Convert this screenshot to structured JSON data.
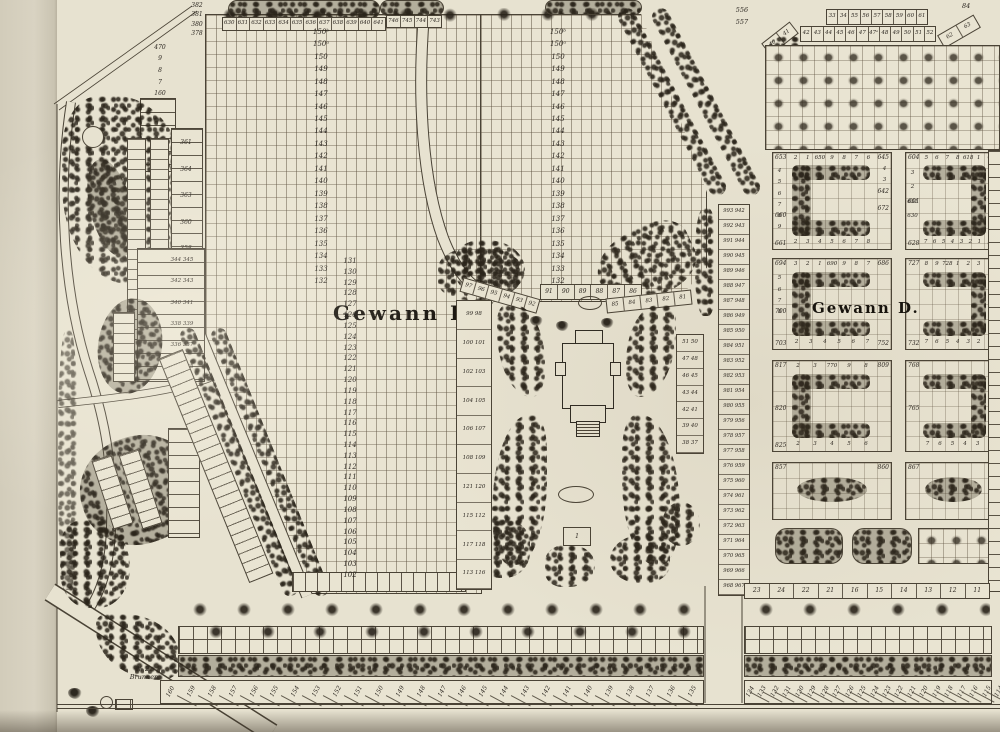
{
  "labels": {
    "gewann_west": "Gewann F.",
    "gewann_east": "Gewann D.",
    "well_no": "№ 2.",
    "well_name": "Brunnen",
    "chapel_plot": "1",
    "corner_right_top": "84"
  },
  "field_columns": {
    "west_upper": [
      "150ᵇ",
      "150ᵃ",
      "150",
      "149",
      "148",
      "147",
      "146",
      "145",
      "144",
      "143",
      "142",
      "141",
      "140",
      "139",
      "138",
      "137",
      "136",
      "135",
      "134",
      "133",
      "132"
    ],
    "west_lower": [
      "131",
      "130",
      "129",
      "128",
      "127",
      "126",
      "125",
      "124",
      "123",
      "122",
      "121",
      "120",
      "119",
      "118",
      "117",
      "116",
      "115",
      "114",
      "113",
      "112",
      "111",
      "110",
      "109",
      "108",
      "107",
      "106",
      "105",
      "104",
      "103",
      "102"
    ],
    "east_upper": [
      "150ᵇ",
      "150ᵃ",
      "150",
      "149",
      "148",
      "147",
      "146",
      "145",
      "144",
      "143",
      "142",
      "141",
      "140",
      "139",
      "138",
      "137",
      "136",
      "135",
      "134",
      "133",
      "132"
    ]
  },
  "west_side": {
    "column": [
      "361",
      "364",
      "363",
      "360",
      "358",
      "356",
      "353",
      "352"
    ],
    "pairs": [
      "344 345",
      "342 343",
      "340 341",
      "338 339",
      "336 337",
      "334 335"
    ]
  },
  "top_left": {
    "corner_column": [
      "382",
      "381",
      "380",
      "378"
    ],
    "edge_column": [
      "470",
      "9",
      "8",
      "7",
      "160"
    ]
  },
  "top_strip": {
    "row_main": [
      "630",
      "631",
      "632",
      "633",
      "634",
      "635",
      "636",
      "637",
      "638",
      "639",
      "640",
      "641"
    ],
    "row_right": [
      "746",
      "745",
      "744",
      "743"
    ]
  },
  "top_right": {
    "labels": [
      "556",
      "557"
    ],
    "row1": [
      "33",
      "34",
      "55",
      "56",
      "57",
      "58",
      "59",
      "60",
      "61"
    ],
    "row2": [
      "42",
      "43",
      "44",
      "45",
      "46",
      "47",
      "47ᵃ",
      "48",
      "49",
      "50",
      "51",
      "52"
    ],
    "diag_left": [
      "40",
      "41"
    ],
    "diag_right": [
      "62",
      "63"
    ]
  },
  "plaza": {
    "strip_diag_left": [
      "97",
      "96",
      "95",
      "94",
      "93",
      "92"
    ],
    "strip_center": [
      "91",
      "90",
      "89",
      "88",
      "87",
      "86"
    ],
    "strip_right": [
      "85",
      "84",
      "83",
      "82",
      "81"
    ],
    "pairs_left": [
      "99 98",
      "100 101",
      "102 103",
      "104 105",
      "106 107",
      "108 109",
      "121 120",
      "115 112",
      "117 118",
      "113 116"
    ],
    "pairs_right": [
      "51 50",
      "47 48",
      "46 45",
      "43 44",
      "42 41",
      "39 40",
      "38 37"
    ]
  },
  "east_strip": {
    "pairs": [
      "993 942",
      "992 943",
      "991 944",
      "990 945",
      "989 946",
      "988 947",
      "987 948",
      "986 949",
      "985 950",
      "984 951",
      "983 952",
      "982 953",
      "981 954",
      "980 955",
      "979 956",
      "978 957",
      "977 958",
      "976 959",
      "975 960",
      "974 961",
      "973 962",
      "972 963",
      "971 964",
      "970 965",
      "969 966",
      "968 967"
    ]
  },
  "blocks": {
    "b1": {
      "tl": "653",
      "tr": "645",
      "ml": "660",
      "bl": "661",
      "mr": "642",
      "mr2": "672",
      "top_digits": [
        "2",
        "1",
        "650",
        "9",
        "8",
        "7",
        "6"
      ],
      "left_digits": [
        "4",
        "5",
        "6",
        "7",
        "8",
        "9"
      ],
      "right_digits": [
        "4",
        "3"
      ],
      "bottom_digits": [
        "2",
        "3",
        "4",
        "5",
        "6",
        "7",
        "8"
      ]
    },
    "b2": {
      "tl": "604",
      "tr": "612",
      "ml": "601",
      "bl": "628",
      "br": "620",
      "top_digits": [
        "5",
        "6",
        "7",
        "8",
        "618",
        "1"
      ],
      "left_digits": [
        "3",
        "2",
        "631",
        "630"
      ],
      "right_digits": [
        "613",
        "4",
        "615",
        "6",
        "7"
      ],
      "bottom_digits": [
        "7",
        "6",
        "5",
        "4",
        "3",
        "2",
        "1"
      ]
    },
    "b3": {
      "tl": "694",
      "tr": "686",
      "ml": "700",
      "bl": "703",
      "br": "752",
      "top_digits": [
        "3",
        "2",
        "1",
        "690",
        "9",
        "8",
        "7"
      ],
      "left_digits": [
        "5",
        "6",
        "7",
        "8"
      ],
      "bottom_digits": [
        "2",
        "3",
        "4",
        "5",
        "6",
        "7"
      ]
    },
    "b4": {
      "tl": "727",
      "tr": "735",
      "bl": "732",
      "br": "711",
      "top_digits": [
        "8",
        "9",
        "728",
        "1",
        "2",
        "3"
      ],
      "bottom_digits": [
        "7",
        "6",
        "5",
        "4",
        "3",
        "2"
      ]
    },
    "b5": {
      "tl": "817",
      "tr": "809",
      "ml": "820",
      "bl": "825",
      "top_digits": [
        "2",
        "3",
        "770",
        "9",
        "8"
      ],
      "bottom_digits": [
        "2",
        "3",
        "4",
        "5",
        "6"
      ]
    },
    "b6": {
      "tl": "768",
      "tr": "776",
      "ml": "765",
      "bottom_digits": [
        "7",
        "6",
        "5",
        "4",
        "3"
      ]
    },
    "b7": {
      "tl": "857",
      "tr": "860"
    },
    "b8": {
      "tl": "867"
    }
  },
  "bottom": {
    "south_row": [
      "23",
      "24",
      "22",
      "21",
      "16",
      "15",
      "14",
      "13",
      "12",
      "11"
    ],
    "row_west": [
      "160",
      "159",
      "158",
      "157",
      "156",
      "155",
      "154",
      "153",
      "152",
      "151",
      "150",
      "149",
      "148",
      "147",
      "146",
      "145",
      "144",
      "143",
      "142",
      "141",
      "140",
      "139",
      "138",
      "137",
      "136",
      "135"
    ],
    "row_east": [
      "134",
      "133",
      "132",
      "131",
      "130",
      "129",
      "128",
      "127",
      "126",
      "125",
      "124",
      "123",
      "122",
      "121",
      "120",
      "119",
      "118",
      "117",
      "116",
      "115",
      "114",
      "113",
      "112",
      "111"
    ]
  }
}
